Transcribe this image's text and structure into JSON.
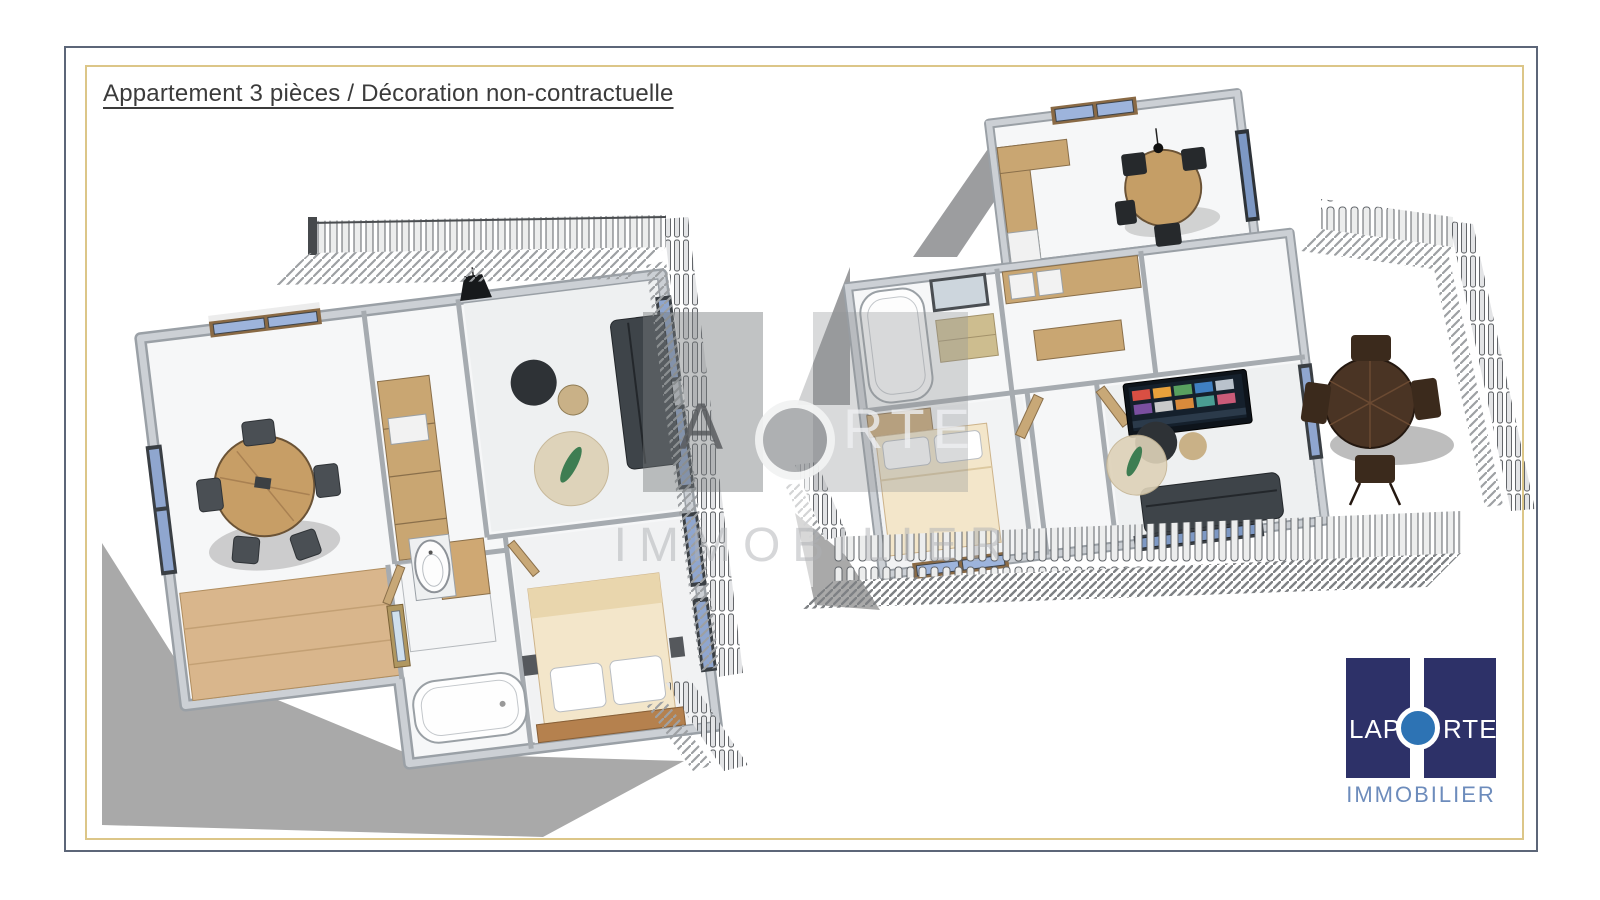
{
  "document": {
    "title": "Appartement 3 pièces / Décoration non-contractuelle"
  },
  "branding": {
    "logo": {
      "word_left": "LAP",
      "word_right": "RTE",
      "subtitle": "IMMOBILIER"
    },
    "watermark": {
      "letter_left": "A",
      "letters_right": "RTE",
      "subtitle": "IMMOBILIER"
    },
    "colors": {
      "logo_navy": "#2d3168",
      "logo_circle_blue": "#2d73b4",
      "logo_subtitle_blue": "#6d8cbc",
      "frame_gold": "#dcc688",
      "frame_slate": "#5c6678"
    }
  }
}
